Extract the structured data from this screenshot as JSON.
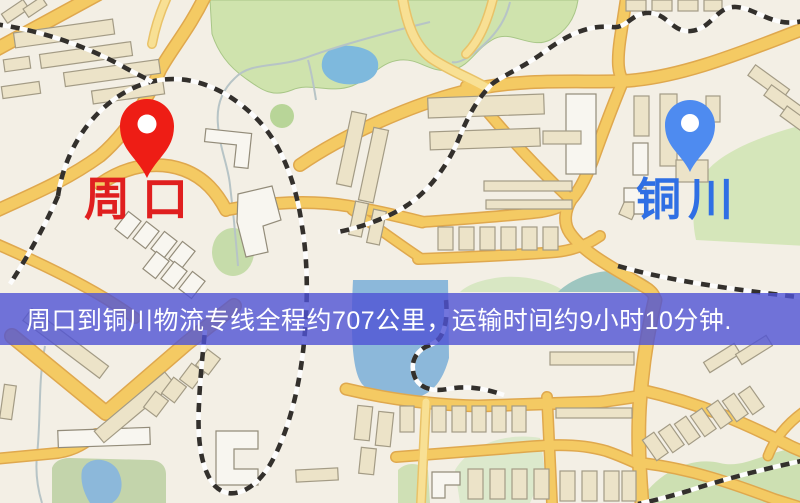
{
  "map": {
    "origin": {
      "label": "周口",
      "label_color": "#e01f1f",
      "pin_color": "#ee1d15"
    },
    "destination": {
      "label": "铜川",
      "label_color": "#2f6fe4",
      "pin_color": "#4e8bf0"
    },
    "legend": {
      "road_color": "#f4ca63",
      "park_color": "#cfe3ad",
      "water_color": "#8cb8da",
      "railway_color": "#33302c",
      "background_color": "#f3efe5"
    }
  },
  "banner": {
    "text": "周口到铜川物流专线全程约707公里，运输时间约9小时10分钟.",
    "bg_color": "rgba(79,82,213,0.80)",
    "text_color": "#ffffff"
  },
  "route": {
    "distance": "约707公里",
    "duration": "约9小时10分钟"
  }
}
